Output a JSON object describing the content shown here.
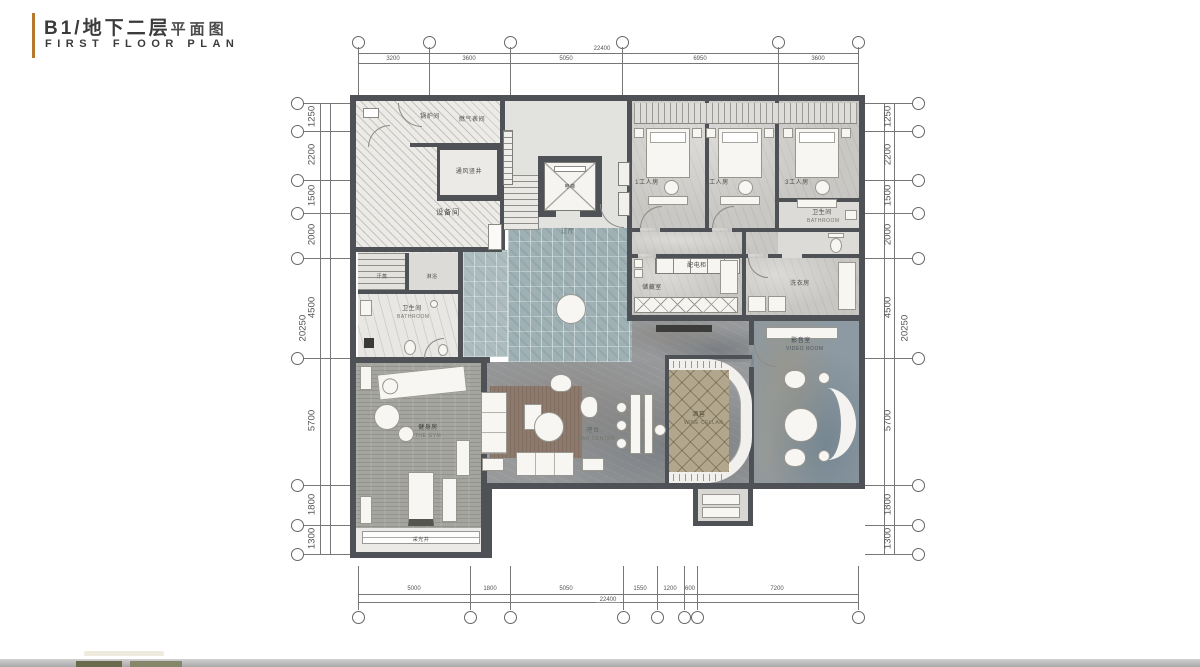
{
  "title": {
    "cn_main": "B1/地下二层",
    "cn_sub": "平面图",
    "en": "FIRST FLOOR PLAN"
  },
  "colors": {
    "accent": "#b5782f",
    "wall": "#4e5257",
    "hall_tile": "#9fb1b5",
    "wine_floor": "#b2a78d",
    "rug": "#8d7a6c",
    "video_floor": "#8d9aa3",
    "footer_bar": "#b8b8b8"
  },
  "dimensions": {
    "top": {
      "overall": "22400",
      "segments": [
        "3200",
        "3600",
        "5050",
        "6950",
        "3600"
      ]
    },
    "bottom": {
      "overall": "22400",
      "segments": [
        "5000",
        "1800",
        "5050",
        "1550",
        "1200",
        "600",
        "7200"
      ]
    },
    "left": {
      "overall": "20250",
      "segments": [
        "1250",
        "2200",
        "1500",
        "2000",
        "4500",
        "5700",
        "1800",
        "1300"
      ]
    },
    "right": {
      "overall": "20250",
      "segments": [
        "1250",
        "2200",
        "1500",
        "2000",
        "4500",
        "5700",
        "1800",
        "1300"
      ]
    }
  },
  "rooms": {
    "boiler": {
      "label": "锅炉间"
    },
    "gas_meter": {
      "label": "燃气表间"
    },
    "shaft": {
      "label": "通风竖井"
    },
    "equipment": {
      "label": "设备间"
    },
    "elevator": {
      "label": "电梯"
    },
    "hall": {
      "label": "过厅"
    },
    "worker1": {
      "label": "1工人房"
    },
    "worker2": {
      "label": "2工人房"
    },
    "worker3": {
      "label": "3工人房"
    },
    "worker_bath": {
      "label": "卫生间",
      "sublabel": "BATHROOM"
    },
    "distribution": {
      "label": "配电柜"
    },
    "storage": {
      "label": "储藏室"
    },
    "laundry": {
      "label": "洗衣房"
    },
    "steam": {
      "label": "汗蒸"
    },
    "shower": {
      "label": "淋浴"
    },
    "spa_bath": {
      "label": "卫生间",
      "sublabel": "BATHROOM"
    },
    "gym": {
      "label": "健身房",
      "sublabel": "THE GYM"
    },
    "bar": {
      "label": "吧台",
      "sublabel": "BAR CENTER"
    },
    "wine": {
      "label": "酒窖",
      "sublabel": "WINE CELLAR"
    },
    "video": {
      "label": "影音室",
      "sublabel": "VIDEO ROOM"
    },
    "lightwell": {
      "label": "采光井"
    }
  }
}
